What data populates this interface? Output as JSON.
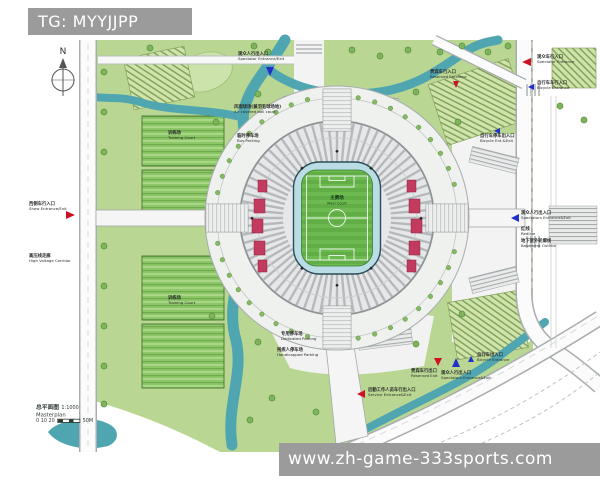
{
  "banners": {
    "tg": "TG: MYYJJPP",
    "site": "www.zh-game-333sports.com"
  },
  "compass": {
    "label": "N"
  },
  "title_block": {
    "title_zh": "总平面图",
    "scale": "1:1000",
    "title_en": "Masterplan",
    "scalebar": "0 10 20",
    "scalebar_end": "50M"
  },
  "stadium": {
    "pitch_label_zh": "主赛场",
    "pitch_label_en": "Main Court"
  },
  "colors": {
    "banner_gray": "#9b9b9b",
    "marker_red": "#cf1126",
    "marker_blue": "#2130c8",
    "river_teal": "#4fa6b1",
    "pitch_green": "#6cba50",
    "landscape_green": "#b9d792",
    "seating_red": "#c23b5e"
  },
  "annotations": [
    {
      "id": "spectator-entrance-top",
      "zh": "观众人行出入口",
      "en": "Spectator Entrance/Exit",
      "x": 238,
      "y": 52,
      "marker": {
        "dir": "down",
        "color": "blue",
        "x": 266,
        "y": 67,
        "s": 9
      }
    },
    {
      "id": "spectator-vehicle-entrance-ne",
      "zh": "观众车行入口",
      "en": "Spectator Entrance",
      "x": 537,
      "y": 55,
      "marker": {
        "dir": "left",
        "color": "red",
        "x": 522,
        "y": 58,
        "s": 9
      }
    },
    {
      "id": "bicycle-entrance-ne",
      "zh": "自行车车行入口",
      "en": "Bicycle Entrance",
      "x": 537,
      "y": 81,
      "marker": {
        "dir": "left",
        "color": "blue",
        "x": 528,
        "y": 84,
        "s": 6
      }
    },
    {
      "id": "reserved-entrance-ne",
      "zh": "贵宾车行入口",
      "en": "Reserved Entrance",
      "x": 430,
      "y": 70,
      "marker": {
        "dir": "down",
        "color": "red",
        "x": 453,
        "y": 81,
        "s": 7
      }
    },
    {
      "id": "bicycle-parking-e",
      "zh": "自行车停车出入口",
      "en": "Bicycle Ent.&Exit",
      "x": 480,
      "y": 134,
      "marker": {
        "dir": "left",
        "color": "blue",
        "x": 494,
        "y": 128,
        "s": 6
      }
    },
    {
      "id": "spectators-entrance-e",
      "zh": "观众人行出入口",
      "en": "Spectators Entrance&Exit",
      "x": 521,
      "y": 211,
      "marker": {
        "dir": "left",
        "color": "blue",
        "x": 511,
        "y": 214,
        "s": 8
      }
    },
    {
      "id": "redline-e",
      "zh": "红线",
      "en": "Redline",
      "x": 521,
      "y": 227
    },
    {
      "id": "basement-outline-e",
      "zh": "地下室外轮廓线",
      "en": "Basement Outline",
      "x": 521,
      "y": 239
    },
    {
      "id": "show-entrance-w",
      "zh": "西侧车行入口",
      "en": "Show Entrance/Exit",
      "x": 29,
      "y": 202,
      "marker": {
        "dir": "right",
        "color": "red",
        "x": 66,
        "y": 211,
        "s": 9
      }
    },
    {
      "id": "high-voltage-w",
      "zh": "高压线走廊",
      "en": "High Voltage Corridor",
      "x": 29,
      "y": 254
    },
    {
      "id": "air-court-nw",
      "zh": "风雨球场(兼羽毛球场地)",
      "en": "Air covered ball court",
      "x": 234,
      "y": 105
    },
    {
      "id": "bus-parking-nw",
      "zh": "临时停车场",
      "en": "Bus Parking",
      "x": 237,
      "y": 134
    },
    {
      "id": "training-court-1",
      "zh": "训练场",
      "en": "Training Court",
      "x": 168,
      "y": 131
    },
    {
      "id": "training-court-3",
      "zh": "训练场",
      "en": "Training Court",
      "x": 168,
      "y": 296
    },
    {
      "id": "dedicated-parking-s",
      "zh": "专用停车场",
      "en": "Dedicated Parking",
      "x": 281,
      "y": 332
    },
    {
      "id": "handicapped-parking-s",
      "zh": "残疾人停车场",
      "en": "Handicapped Parking",
      "x": 277,
      "y": 348
    },
    {
      "id": "reserved-exit-s",
      "zh": "贵宾车行出口",
      "en": "Reserved Exit",
      "x": 411,
      "y": 369,
      "marker": {
        "dir": "down",
        "color": "red",
        "x": 434,
        "y": 358,
        "s": 8
      }
    },
    {
      "id": "spectators-entrance-s",
      "zh": "观众人行出入口",
      "en": "Spectators Entrance&Exit",
      "x": 441,
      "y": 371,
      "marker": {
        "dir": "up",
        "color": "blue",
        "x": 452,
        "y": 358,
        "s": 9
      }
    },
    {
      "id": "bicycle-entrance-s",
      "zh": "自行车出入口",
      "en": "Bicycle Entrance",
      "x": 477,
      "y": 353,
      "marker": {
        "dir": "up",
        "color": "blue",
        "x": 468,
        "y": 356,
        "s": 6
      }
    },
    {
      "id": "service-entrance-s",
      "zh": "后勤工作人员车行出入口",
      "en": "Service Entrance&Exit",
      "x": 368,
      "y": 388,
      "marker": {
        "dir": "left",
        "color": "red",
        "x": 357,
        "y": 390,
        "s": 8
      }
    }
  ]
}
